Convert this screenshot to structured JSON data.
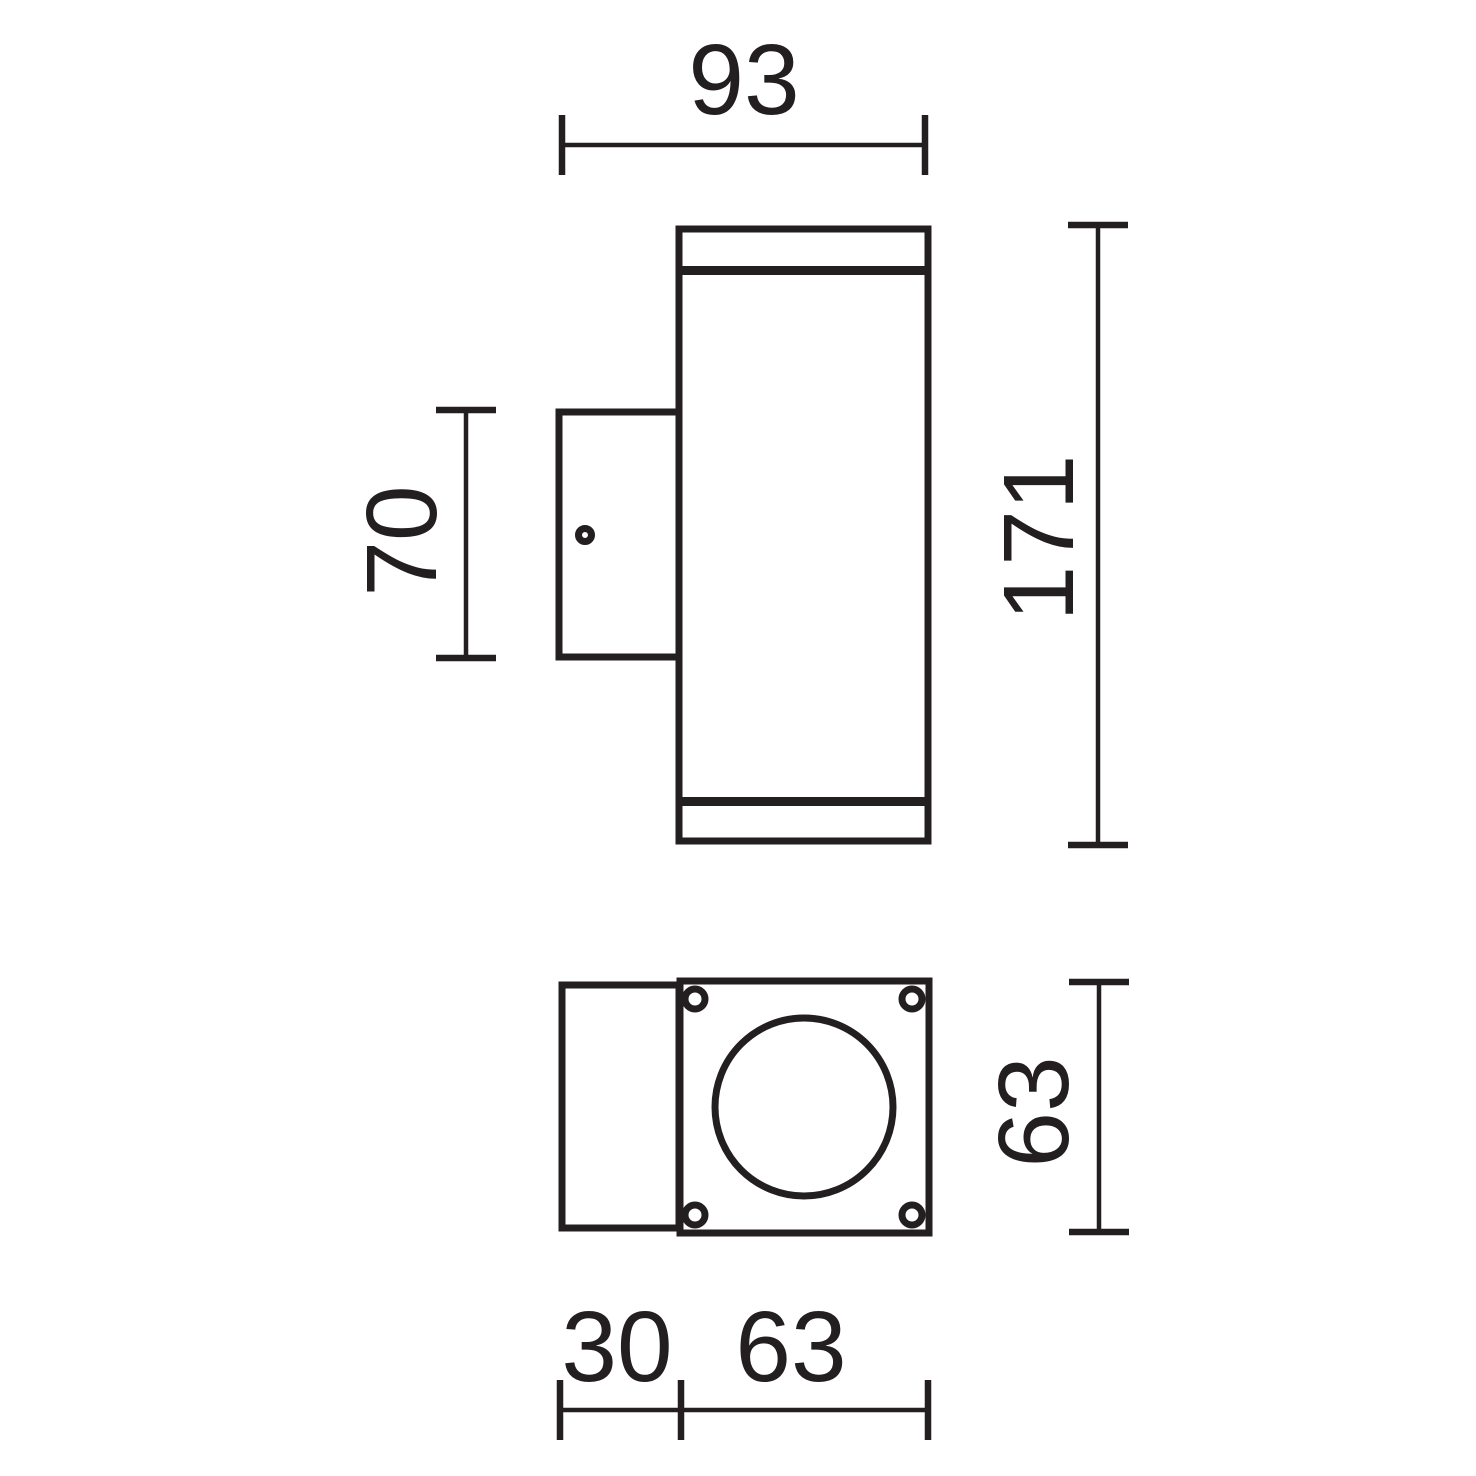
{
  "colors": {
    "line": "#231f20",
    "background": "#ffffff"
  },
  "dimensions": {
    "overall_depth": "93",
    "overall_height": "171",
    "bracket_height": "70",
    "plate_height": "63",
    "bracket_depth": "30",
    "plate_width": "63"
  }
}
